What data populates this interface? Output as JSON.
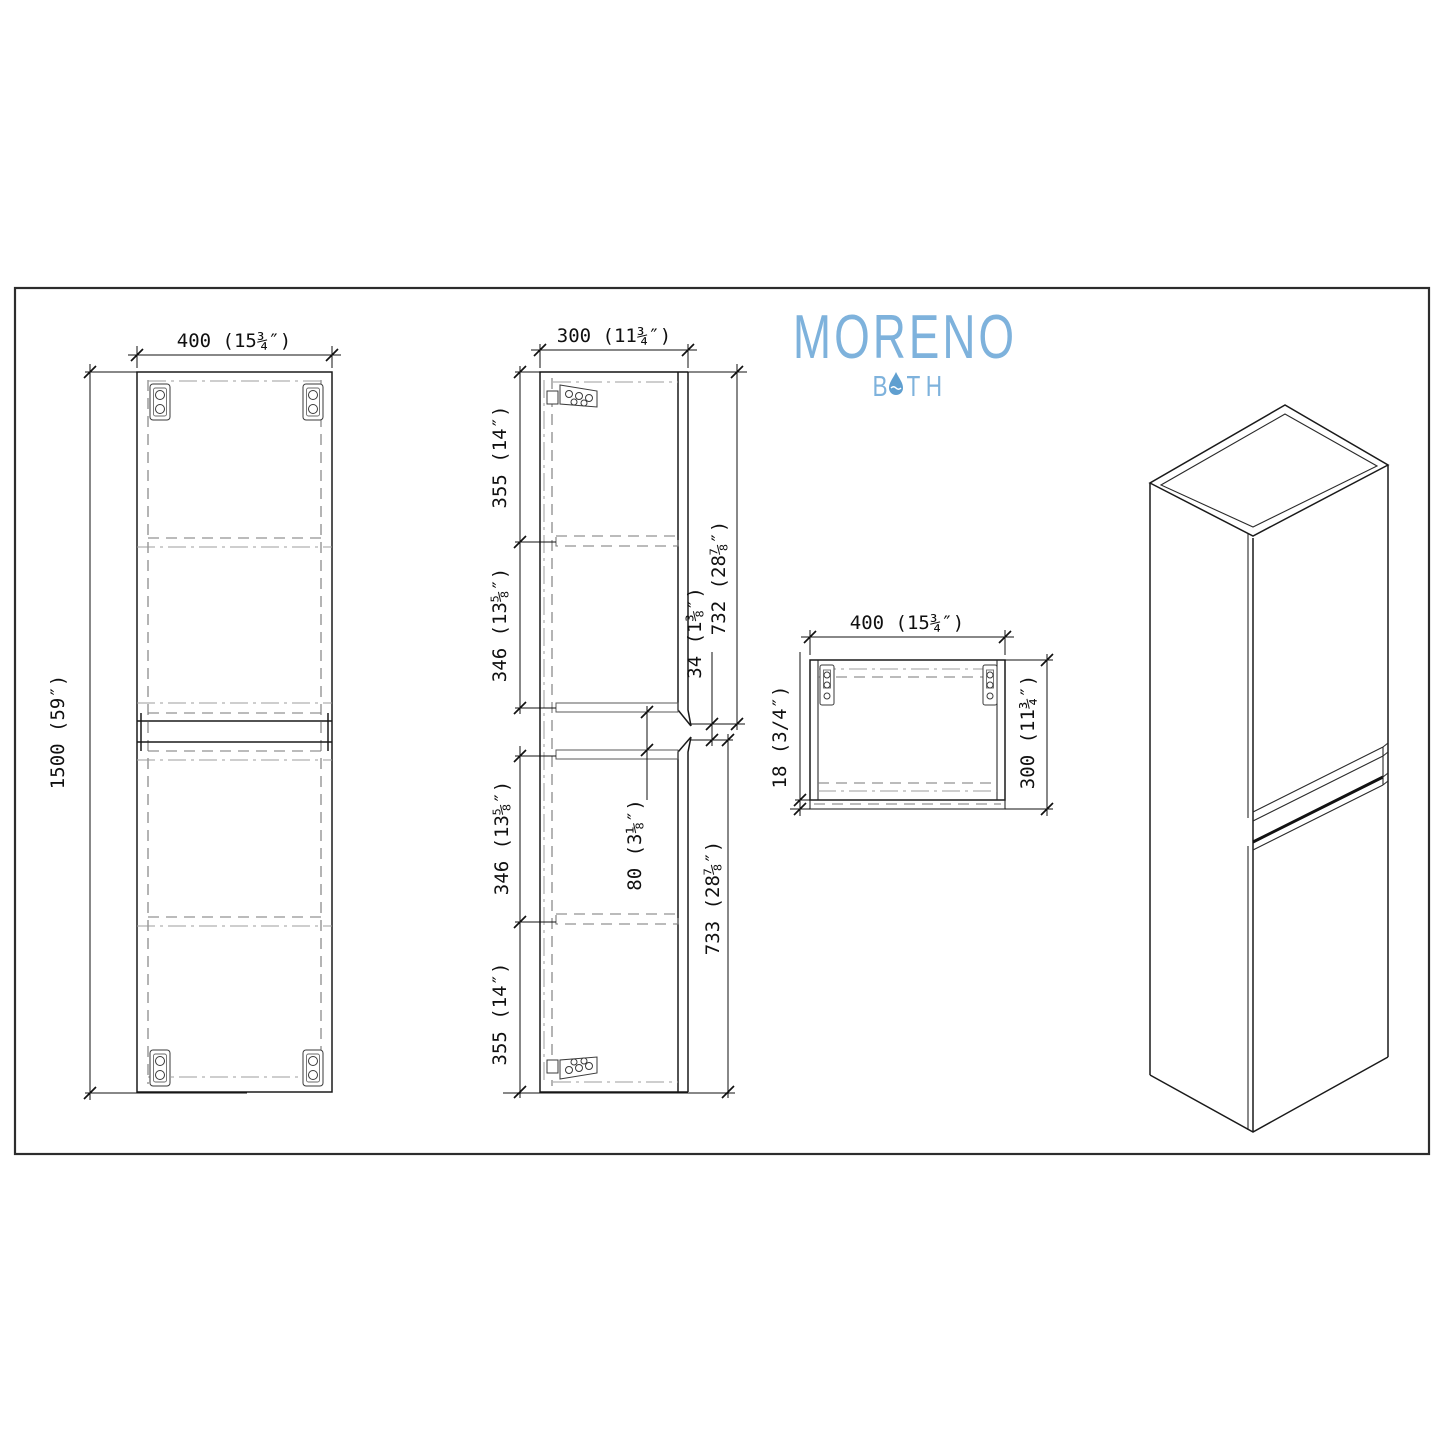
{
  "brand": {
    "name": "MORENO",
    "tagline_b": "B",
    "tagline_th": "TH",
    "color": "#7EB2DC",
    "drop_color": "#5F9FD0"
  },
  "views": {
    "front": {
      "width_label": "400 (15¾″)",
      "height_label": "1500 (59″)"
    },
    "side": {
      "depth_label": "300 (11¾″)",
      "segments": [
        "355 (14″)",
        "346 (13⅝″)",
        "346 (13⅝″)",
        "355 (14″)"
      ],
      "upper_door_label": "732 (28⅞″)",
      "door_gap_label": "34 (1⅜″)",
      "groove_label": "80 (3⅛″)",
      "lower_door_label": "733 (28⅞″)"
    },
    "top": {
      "width_label": "400 (15¾″)",
      "depth_label": "300 (11¾″)",
      "back_panel_label": "18 (3/4″)"
    }
  }
}
